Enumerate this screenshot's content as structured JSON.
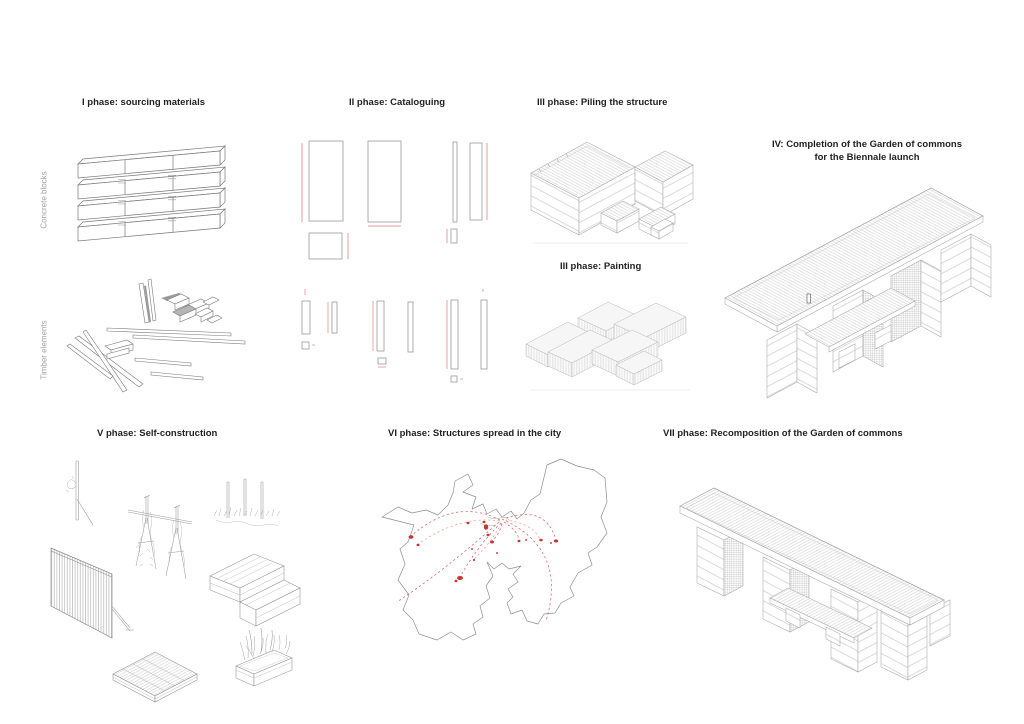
{
  "colors": {
    "background": "#ffffff",
    "heading_text": "#222222",
    "side_label_text": "#a3a3a3",
    "line_art": "#8a8a8a",
    "light_line": "#c8c8c8",
    "catalog_red": "#e49c9c",
    "map_red": "#cc3333"
  },
  "side_labels": {
    "concrete": "Concrete blocks",
    "timber": "Timber elements"
  },
  "phases": [
    {
      "id": "phase-1",
      "label": "I phase: sourcing materials"
    },
    {
      "id": "phase-2",
      "label": "II phase: Cataloguing"
    },
    {
      "id": "phase-3-piling",
      "label": "III phase: Piling the structure"
    },
    {
      "id": "phase-3-painting",
      "label": "III phase: Painting"
    },
    {
      "id": "phase-4",
      "label": "IV: Completion of the Garden of commons",
      "label_line2": "for the Biennale launch"
    },
    {
      "id": "phase-5",
      "label": "V phase: Self-construction"
    },
    {
      "id": "phase-6",
      "label": "VI phase: Structures spread in the city"
    },
    {
      "id": "phase-7",
      "label": "VII phase: Recomposition of the Garden of commons"
    }
  ]
}
